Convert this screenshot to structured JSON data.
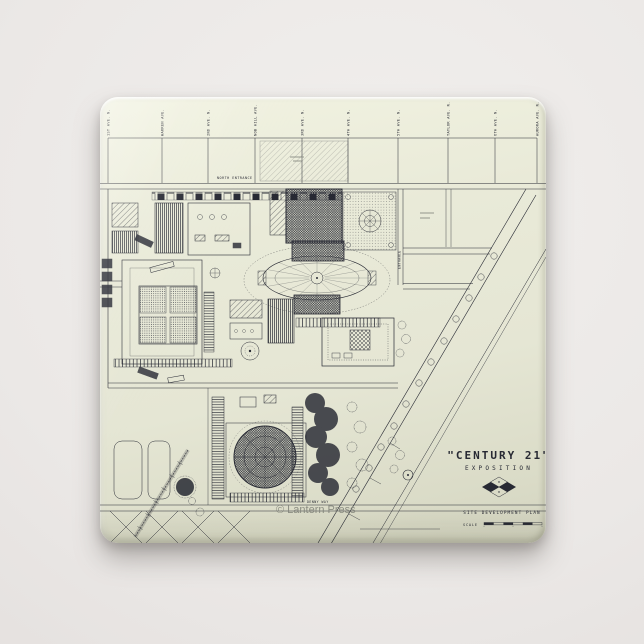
{
  "scene": {
    "background_color": "#ebe8e6",
    "shadow_color": "rgba(96,89,85,0.40)"
  },
  "pin": {
    "paper_color": "#e6e7d5",
    "paper_highlight": "#f2f3e2",
    "paper_shade": "#d2d3bf",
    "ink_color": "#272933"
  },
  "map": {
    "title": "\"CENTURY 21\"",
    "subtitle": "EXPOSITION",
    "plan_label": "SITE DEVELOPMENT PLAN",
    "scale_label": "SCALE",
    "watermark": "© Lantern Press",
    "labels": {
      "north_entrance": "NORTH ENTRANCE",
      "entrance": "ENTRANCE",
      "denny_way": "DENNY WAY"
    },
    "streets": [
      "1ST AVE. N.",
      "WARREN AVE.",
      "2ND AVE. N.",
      "NOB HILL AVE.",
      "3RD AVE. N.",
      "4TH AVE. N.",
      "5TH AVE. N.",
      "TAYLOR AVE. N.",
      "6TH AVE. N.",
      "AURORA AVE. N."
    ]
  }
}
